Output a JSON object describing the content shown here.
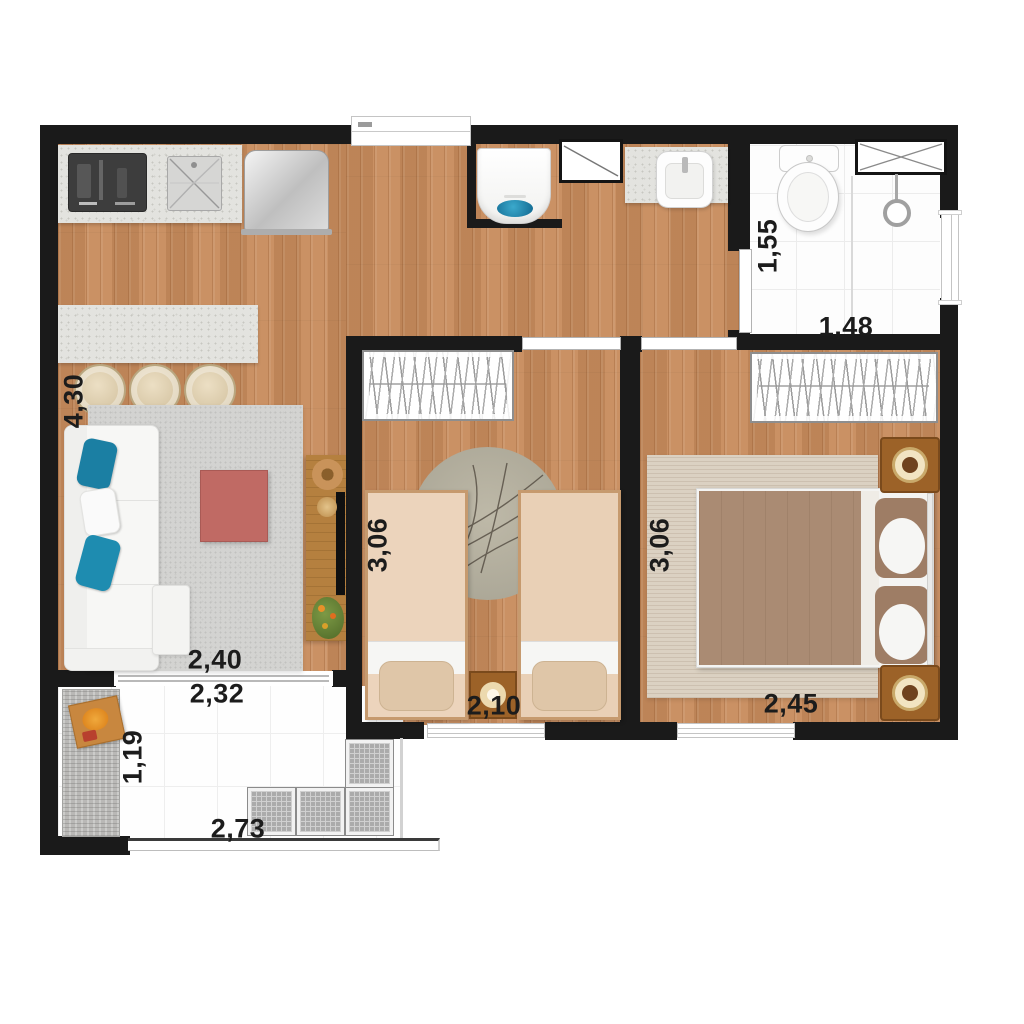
{
  "canvas": {
    "width": 1024,
    "height": 1024,
    "background": "#ffffff"
  },
  "palette": {
    "wall": "#1a1a1a",
    "wood": "#c78b5c",
    "tile": "#fdfdfd",
    "granite": "#e3e3df",
    "living_rug": "#d3d3d1",
    "sofa": "#f7f7f5",
    "pillow_teal": "#1b7fa3",
    "coffee_table": "#c06a64",
    "console_wood": "#b5803f",
    "twin_bed_cover": "#ecd4bc",
    "double_bed_cover": "#aa8b73",
    "nightstand_wood": "#9c6228",
    "lamp_cream": "#f2e4c2",
    "washer_water": "#1d8cb7",
    "grate_gray": "#ababab"
  },
  "rooms": {
    "living_kitchen": {
      "dim_depth": "4,30",
      "dim_width": "2,40",
      "items": [
        "kitchen-counter",
        "cooktop",
        "kitchen-sink",
        "refrigerator",
        "island-counter",
        "stool",
        "stool",
        "stool",
        "sofa",
        "throw-pillows",
        "area-rug",
        "coffee-table",
        "tv-console",
        "tv",
        "decor-basket",
        "decor-bowl",
        "decor-plant"
      ]
    },
    "hall_laundry": {
      "items": [
        "washing-machine",
        "duct-shaft",
        "vanity-counter",
        "wash-basin"
      ]
    },
    "bathroom": {
      "dim_depth": "1,55",
      "dim_width": "1,48",
      "items": [
        "toilet",
        "shower-head",
        "shower-partition",
        "duct-shaft",
        "window",
        "door"
      ]
    },
    "bedroom_twin": {
      "dim_depth": "3,06",
      "dim_width": "2,10",
      "items": [
        "wardrobe",
        "single-bed",
        "single-bed",
        "round-rug",
        "nightstand",
        "lamp",
        "window",
        "door"
      ]
    },
    "bedroom_double": {
      "dim_depth": "3,06",
      "dim_width": "2,45",
      "items": [
        "wardrobe",
        "double-bed",
        "area-rug",
        "nightstand",
        "lamp",
        "nightstand",
        "lamp",
        "window",
        "door"
      ]
    },
    "balcony": {
      "dim_width_top": "2,32",
      "dim_depth": "1,19",
      "dim_width_bottom": "2,73",
      "items": [
        "outdoor-rug",
        "serving-tray",
        "floor-grates",
        "glass-railing",
        "sliding-door"
      ]
    }
  }
}
